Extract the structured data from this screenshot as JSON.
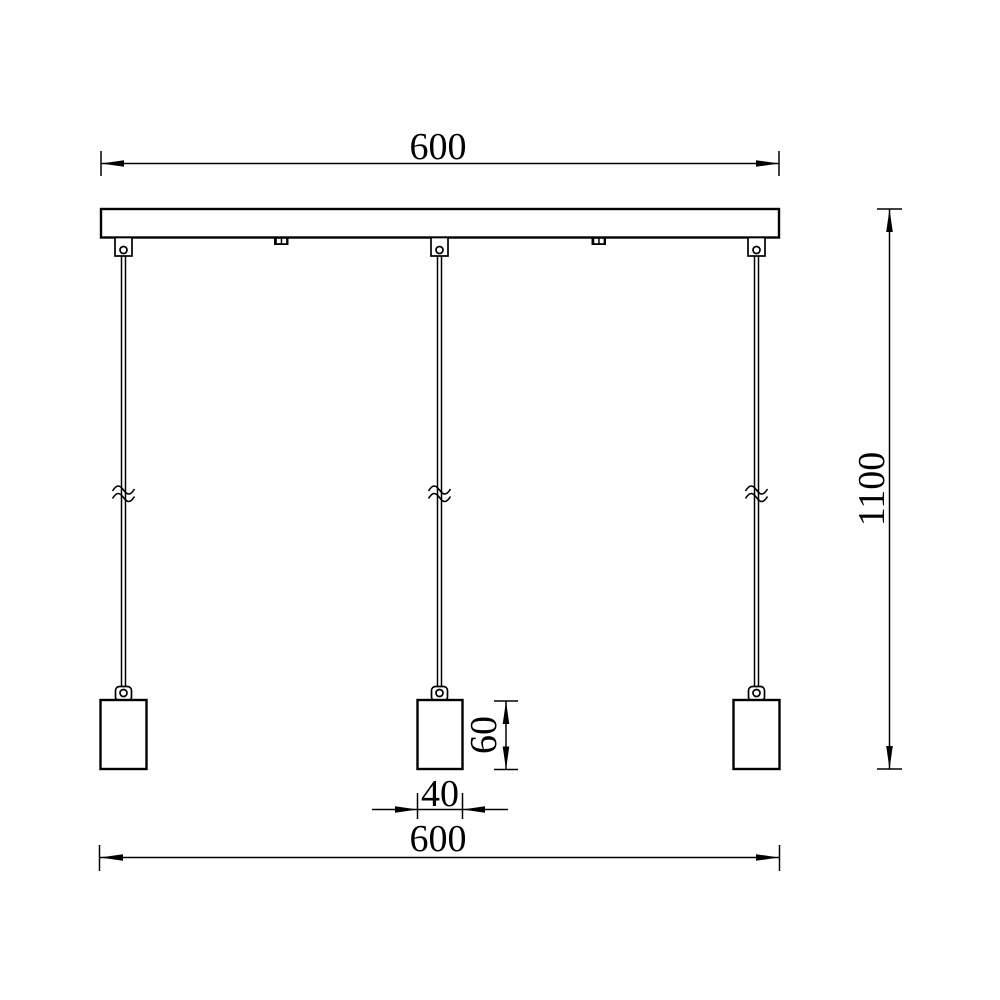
{
  "drawing": {
    "title": "three-light linear pendant dimension drawing",
    "colors": {
      "background": "#ffffff",
      "line": "#000000"
    },
    "dimensions": {
      "canopy_width_top": "600",
      "overall_height": "1100",
      "shade_height": "60",
      "shade_width": "40",
      "overall_width_bottom": "600"
    }
  }
}
